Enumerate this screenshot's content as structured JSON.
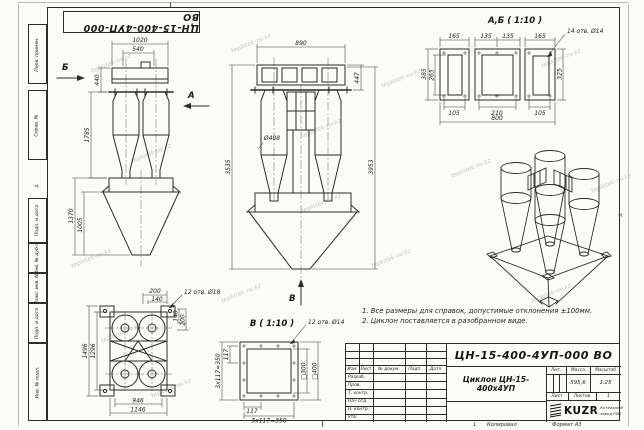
{
  "watermark": "teplotek-nv.kz",
  "stamp_top": "ЦН-15-400-4УП-000 ВО",
  "zone_marker": "А",
  "frame": {
    "left_labels": [
      "Перв. примен.",
      "Справ. №",
      "Подп. и дата",
      "Инв. № дубл.",
      "Взам. инв. №",
      "Подп. и дата",
      "Инв. № подл."
    ]
  },
  "views": {
    "front": {
      "label_b": "Б",
      "label_a": "А",
      "dims": [
        "1020",
        "540",
        "440",
        "1785",
        "1370",
        "1005"
      ]
    },
    "side": {
      "label_v": "В",
      "dims": [
        "890",
        "447",
        "Ø408",
        "3535",
        "3953"
      ]
    },
    "section_ab": {
      "title": "А,Б ( 1:10 )",
      "holes_note": "14 отв. Ø14",
      "dims": [
        "165",
        "135",
        "135",
        "165",
        "385",
        "265",
        "325",
        "105",
        "210",
        "105",
        "800"
      ]
    },
    "plan": {
      "holes_note": "12 отв. Ø18",
      "dims": [
        "200",
        "140",
        "140",
        "200",
        "1496",
        "1296",
        "946",
        "1146"
      ]
    },
    "section_v": {
      "title": "В ( 1:10 )",
      "holes_note": "12 отв. Ø14",
      "dims": [
        "117",
        "3x117=350",
        "□300",
        "□400",
        "117",
        "3x117=350"
      ]
    }
  },
  "notes": [
    "1. Все размеры для справок, допустимые отклонения ±100мм.",
    "2. Циклон поставляется в разобранном виде."
  ],
  "title_block": {
    "designation": "ЦН-15-400-4УП-000 ВО",
    "name": "Циклон ЦН-15-400х4УП",
    "header_cols": [
      "Изм.",
      "Лист",
      "№ докум.",
      "Подп.",
      "Дата"
    ],
    "row_labels": [
      "Разраб.",
      "Пров.",
      "Т. контр.",
      "Нач.отд",
      "Н. контр.",
      "Утв."
    ],
    "lit_label": "Лит.",
    "mass_label": "Масса",
    "scale_label": "Масштаб",
    "mass_value": "595,6",
    "scale_value": "1:25",
    "sheet_label": "Лист",
    "sheets_label": "Листов",
    "sheets_value": "1",
    "logo_text": "KUZR",
    "company_line1": "Котельный",
    "company_line2": "завод РЗП",
    "copied_label": "Копировал",
    "format_label": "Формат А3",
    "sheet_num": "1"
  }
}
